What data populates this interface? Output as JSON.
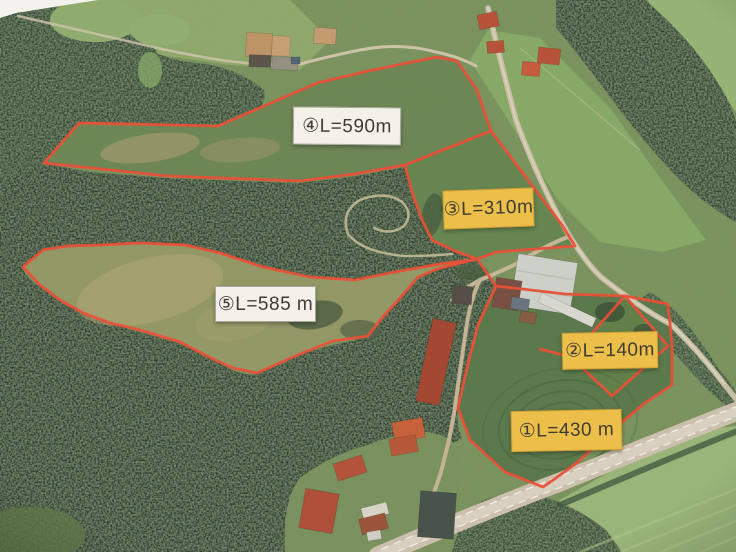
{
  "map": {
    "description": "Aerial photograph with five surveyed land parcels outlined in red",
    "boundary_color": "#e8432a",
    "label_colors": {
      "yellow_bg": "#ecbf4a",
      "white_bg": "#f4f1e9",
      "text": "#3f3c35"
    },
    "parcels": [
      {
        "number": "①",
        "label": "①L=430 m",
        "length_m": 430,
        "box_style": "yellow"
      },
      {
        "number": "②",
        "label": "②L=140m",
        "length_m": 140,
        "box_style": "yellow"
      },
      {
        "number": "③",
        "label": "③L=310m",
        "length_m": 310,
        "box_style": "yellow"
      },
      {
        "number": "④",
        "label": "④L=590m",
        "length_m": 590,
        "box_style": "white"
      },
      {
        "number": "⑤",
        "label": "⑤L=585 m",
        "length_m": 585,
        "box_style": "white"
      }
    ]
  }
}
